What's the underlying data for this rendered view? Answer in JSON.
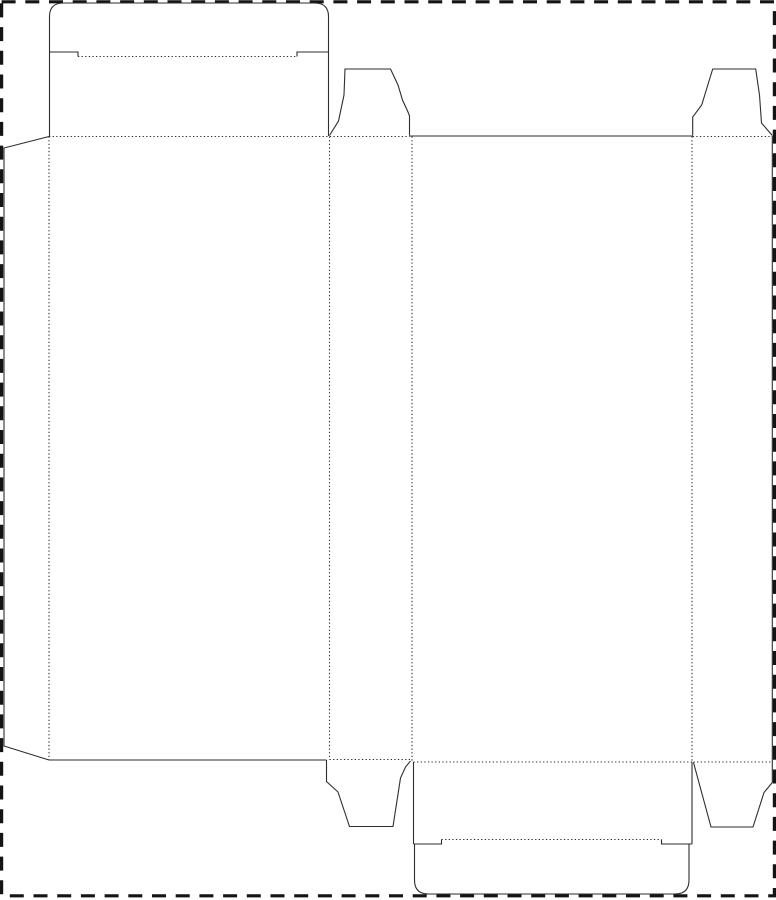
{
  "page": {
    "type": "packaging-dieline",
    "description": "Die-cut template (dieline) for a reverse tuck-end folding carton: cut lines solid, crease/fold lines dotted, trim page border dashed. No text labels present."
  },
  "canvas": {
    "width": 776,
    "height": 900,
    "background": "#ffffff"
  },
  "styles": {
    "cut": {
      "color": "#2e2e2e",
      "width": 1.1,
      "dash": ""
    },
    "fold": {
      "color": "#2e2e2e",
      "width": 1.1,
      "dash": "1.3 2.3"
    },
    "border": {
      "color": "#141414",
      "width": 3.2,
      "dash": "14 9.7"
    }
  },
  "border": {
    "x": 1.6,
    "y": 1.8,
    "w": 772.8,
    "h": 894
  },
  "paths": [
    {
      "name": "top-tuck-flap-outline",
      "type": "cut",
      "d": "M 49.5 52 L 49.5 16.5 Q 49.5 3 63.5 3 L 314.5 3 Q 328.5 3 328.5 16.5 L 328.5 52"
    },
    {
      "name": "top-tuck-notch-left",
      "type": "cut",
      "d": "M 49.5 52 L 78 52 L 78 56.5"
    },
    {
      "name": "top-tuck-notch-right",
      "type": "cut",
      "d": "M 297 56.5 L 297 52 L 328.5 52"
    },
    {
      "name": "lid-panel-left-edge",
      "type": "cut",
      "d": "M 49.5 52 L 49.5 136"
    },
    {
      "name": "lid-panel-right-edge",
      "type": "cut",
      "d": "M 328.5 52 L 328.5 136"
    },
    {
      "name": "glue-flap-outline",
      "type": "cut",
      "d": "M 49 136.5 L 4 148 L 4 746 L 49 760"
    },
    {
      "name": "back-panel-bottom-edge",
      "type": "cut",
      "d": "M 49 760 L 326.5 760"
    },
    {
      "name": "front-panel-top-edge",
      "type": "cut",
      "d": "M 409.5 136 L 692.7 136"
    },
    {
      "name": "dust-flap-top-left-outline",
      "type": "cut",
      "d": "M 329.5 135.5 L 338.5 121 L 344 95 L 345 69 L 390.5 69 L 398 85 L 402.5 100 L 408 112 L 409.5 116 L 409.5 135.5"
    },
    {
      "name": "dust-flap-top-right-outline",
      "type": "cut",
      "d": "M 692.7 135.5 L 692.7 117 L 701.7 105 L 712.7 69 L 755.7 69 L 759.5 95 L 761.5 123 L 772.3 135.5"
    },
    {
      "name": "side-panel-right-edge-and-bottom-flap",
      "type": "cut",
      "d": "M 772.3 136 L 772.3 782.5 L 764 792.5 L 753 827 L 711 827 L 693.5 762.5"
    },
    {
      "name": "dust-flap-bottom-left-outline",
      "type": "cut",
      "d": "M 326.5 760 L 326.5 781.5 L 338 792 L 349.5 826.5 L 393 826.5 L 400.5 778 L 405.5 767 L 410.5 761"
    },
    {
      "name": "bottom-lid-left-edge",
      "type": "cut",
      "d": "M 413.5 762 L 413.5 844"
    },
    {
      "name": "bottom-lid-right-edge",
      "type": "cut",
      "d": "M 692 762 L 692 844"
    },
    {
      "name": "bottom-tuck-notch-left",
      "type": "cut",
      "d": "M 413.5 844 L 441.5 844 L 441.5 839.5"
    },
    {
      "name": "bottom-tuck-notch-right",
      "type": "cut",
      "d": "M 661.5 839.5 L 661.5 844 L 692 844"
    },
    {
      "name": "bottom-tuck-flap-outline",
      "type": "cut",
      "d": "M 414.5 844 L 414.5 880 Q 414.5 894 428.5 894 L 675 894 Q 689 894 689 880 L 689 844"
    },
    {
      "name": "top-tuck-fold",
      "type": "fold",
      "d": "M 78 56.5 L 297 56.5"
    },
    {
      "name": "top-fold-back-and-left-flap",
      "type": "fold",
      "d": "M 49 136.5 L 409.5 136.5"
    },
    {
      "name": "top-fold-right-flap",
      "type": "fold",
      "d": "M 692.7 136.5 L 772 136.5"
    },
    {
      "name": "vertical-fold-glue-to-back",
      "type": "fold",
      "d": "M 49 136.5 L 49 760"
    },
    {
      "name": "vertical-fold-back-to-side",
      "type": "fold",
      "d": "M 329.5 136.5 L 329.5 759.5"
    },
    {
      "name": "vertical-fold-side-to-front",
      "type": "fold",
      "d": "M 412 136.5 L 412 761"
    },
    {
      "name": "vertical-fold-front-to-side",
      "type": "fold",
      "d": "M 692 136.5 L 692 762"
    },
    {
      "name": "bottom-fold-left-flap",
      "type": "fold",
      "d": "M 329.5 759.5 L 410 759.5"
    },
    {
      "name": "bottom-fold-front-panel",
      "type": "fold",
      "d": "M 413.5 762 L 692 762"
    },
    {
      "name": "bottom-fold-right-flap",
      "type": "fold",
      "d": "M 693.5 762 L 772 762"
    },
    {
      "name": "bottom-tuck-fold",
      "type": "fold",
      "d": "M 441.5 839.5 L 661.5 839.5"
    }
  ]
}
